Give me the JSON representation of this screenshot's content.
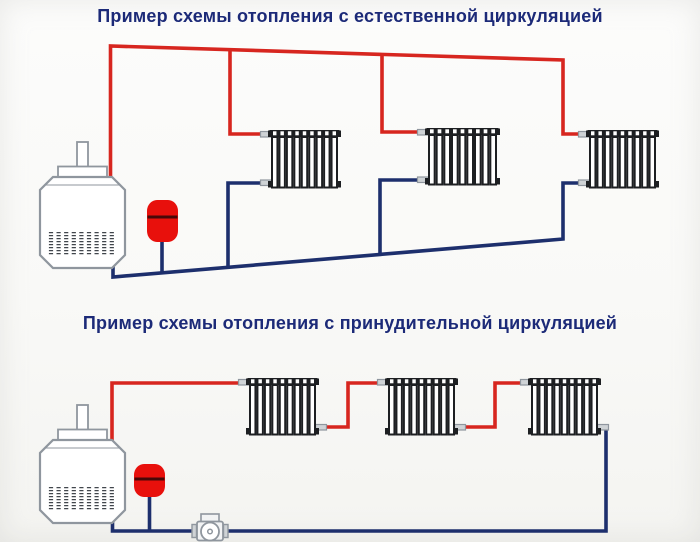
{
  "colors": {
    "supply_pipe": "#d7261f",
    "return_pipe": "#1d2f6d",
    "title_text": "#1c2a78",
    "outline_gray": "#8f969e",
    "radiator_ink": "#1d1f22",
    "tank_red": "#e8100c",
    "tank_band": "#480808",
    "grille_ink": "#41464c",
    "stub_fill": "#cfd3d6",
    "component_fill": "#ffffff",
    "pump_fill": "#f2f3f4"
  },
  "diagram1": {
    "title": "Пример схемы отопления с естественной циркуляцией",
    "radiator_count": 3,
    "components": [
      "boiler",
      "expansion-tank",
      "radiator",
      "radiator",
      "radiator"
    ]
  },
  "diagram2": {
    "title": "Пример схемы отопления с принудительной циркуляцией",
    "radiator_count": 3,
    "components": [
      "boiler",
      "expansion-tank",
      "circulation-pump",
      "radiator",
      "radiator",
      "radiator"
    ]
  }
}
